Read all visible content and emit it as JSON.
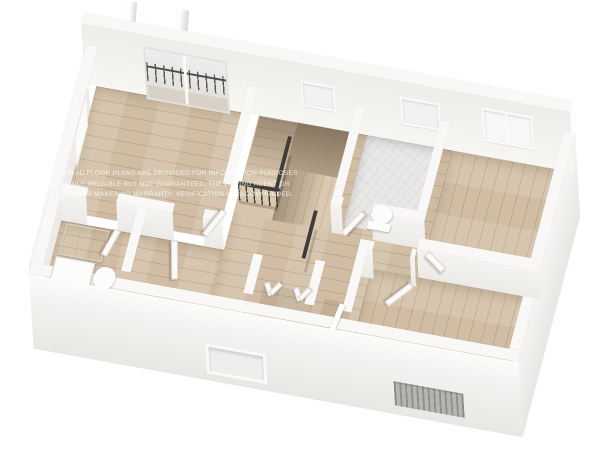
{
  "watermark": {
    "line1": "OUR 3D FLOOR PLANS ARE PROVIDED FOR INFORMATION PURPOSES",
    "line2": "ONLY. RELIABLE BUT NOT GUARANTEED. THE LISTING AGENT OR",
    "line3": "BROKER MAKES NO WARRANTY. VERIFICATION IS RECOMMENDED."
  },
  "colors": {
    "bg": "#ffffff",
    "wall-top": "#f9f8f6",
    "wall-face-hi": "#f5f4f2",
    "wall-face-lo": "#eceae7",
    "wood": "#d5c3aa",
    "marble": "#eae8e7",
    "rail": "#3e3c39",
    "door": "#fbfaf8",
    "glass": "#dfe3e4",
    "fixture": "#fcfcfb"
  }
}
